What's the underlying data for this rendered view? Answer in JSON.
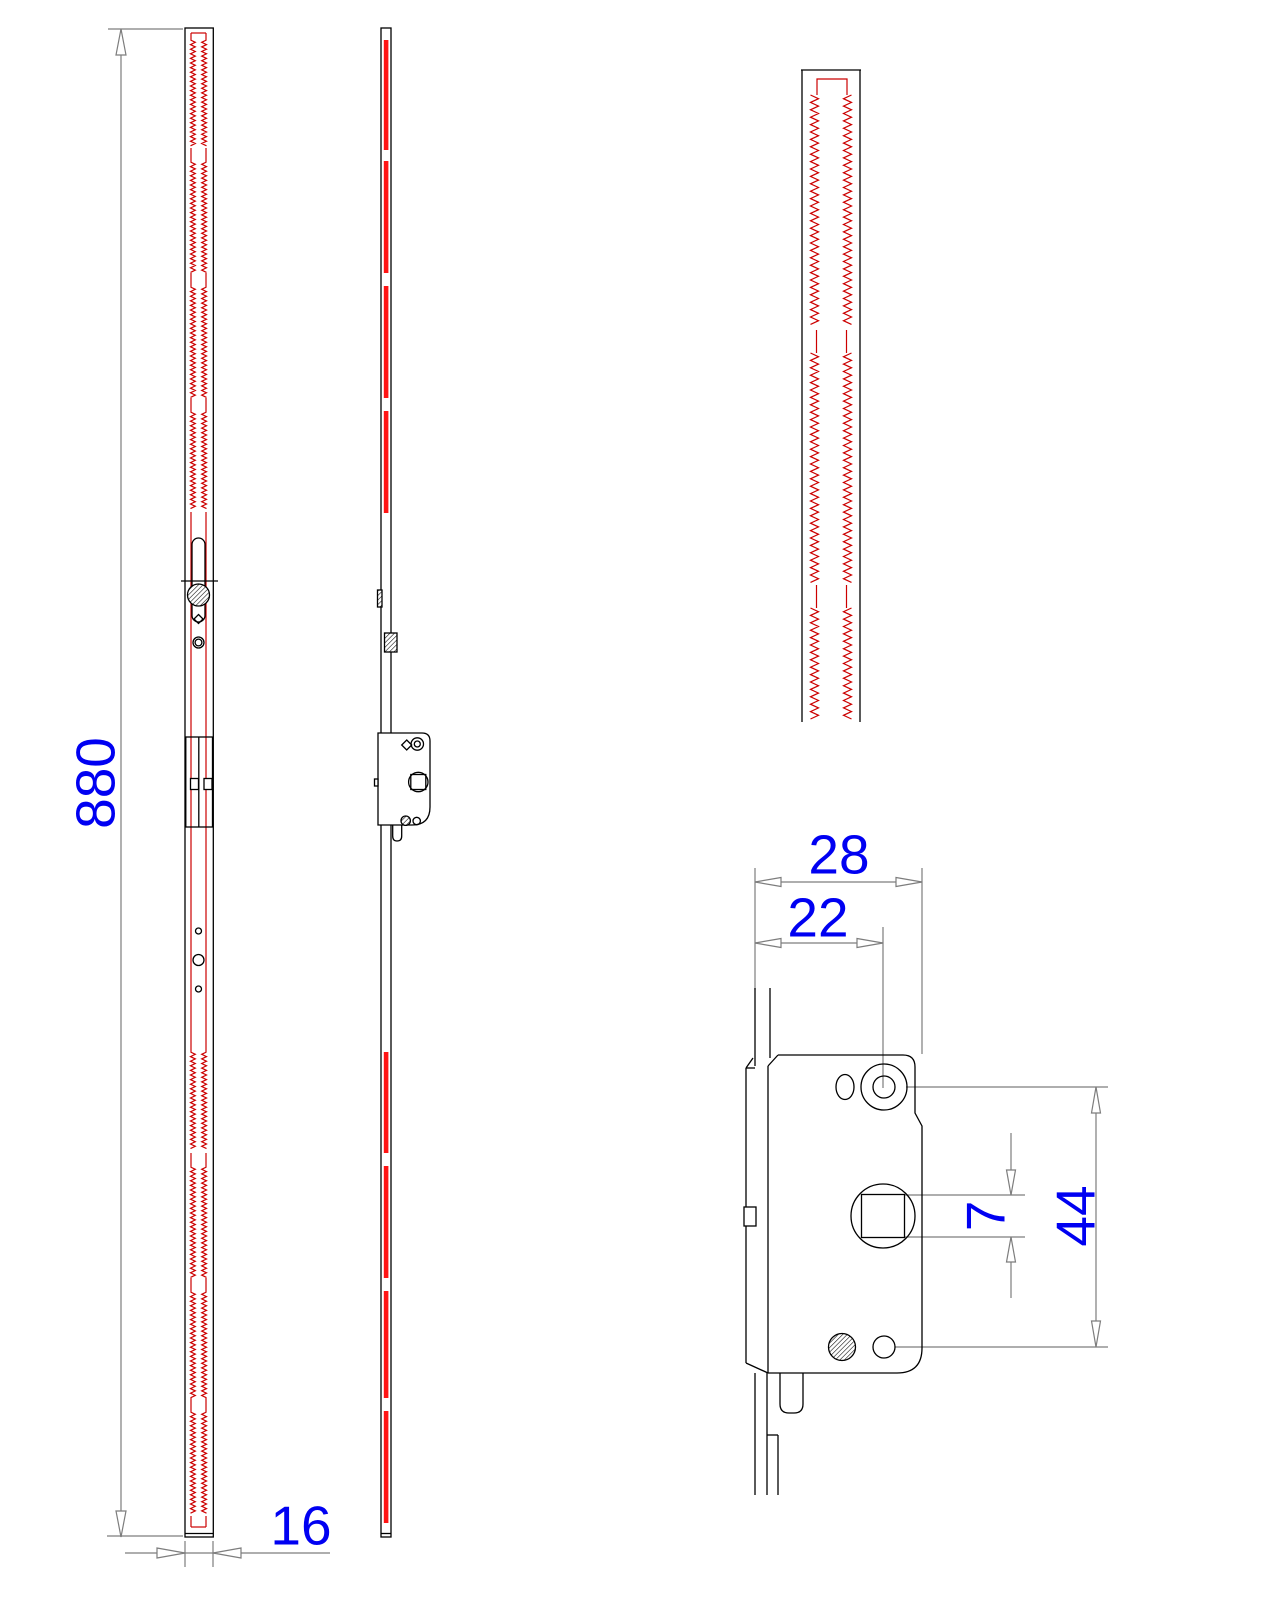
{
  "drawing": {
    "dimensions": {
      "length": "880",
      "width": "16",
      "case_depth": "28",
      "backset": "22",
      "spindle_square": "7",
      "hole_spacing": "44"
    },
    "colors": {
      "background": "#ffffff",
      "outline": "#000000",
      "accent_red": "#cc0000",
      "strip_red": "#ff1414",
      "dimension_gray": "#7d7d7d",
      "dimension_text_blue": "#0000f2"
    }
  }
}
